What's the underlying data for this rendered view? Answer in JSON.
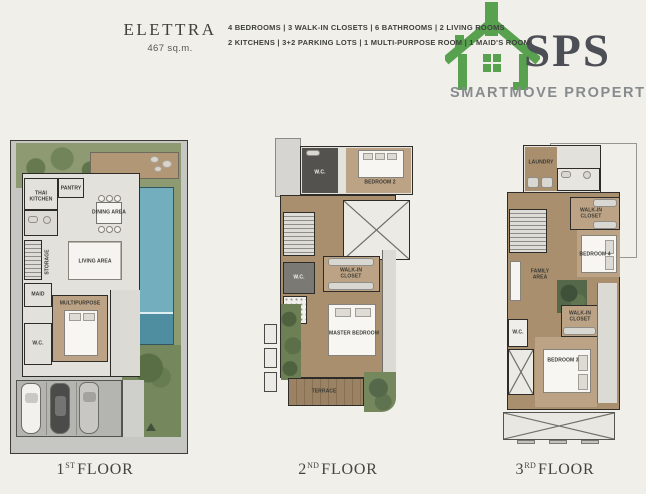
{
  "header": {
    "title": "ELETTRA",
    "area": "467 sq.m.",
    "specs_line1": "4 BEDROOMS   |   3 WALK-IN CLOSETS   |   6 BATHROOMS   |   2 LIVING ROOMS",
    "specs_line2": "2 KITCHENS   |   3+2 PARKING LOTS   |   1 MULTI-PURPOSE ROOM   |   1 MAID'S ROOM"
  },
  "logo": {
    "brand": "SPS",
    "tagline": "SMARTMOVE PROPERTY",
    "house_color": "#57a14f",
    "brand_color": "#4c5056",
    "tagline_color": "#878b8e"
  },
  "colors": {
    "background": "#f1efe9",
    "wall": "#2d2c29",
    "pool_blue": "#73aebe",
    "garden_green": "#8d9a72",
    "wood_floor": "#a98f6e",
    "site_gray": "#c6c6c3"
  },
  "floors": [
    {
      "num": "1",
      "ord": "ST",
      "word": "FLOOR",
      "rooms": {
        "thai_kitchen": "THAI\nKITCHEN",
        "pantry": "PANTRY",
        "dining": "DINING AREA",
        "living": "LIVING AREA",
        "storage": "STORAGE",
        "maid": "MAID",
        "multipurpose": "MULTIPURPOSE",
        "wc": "W.C."
      }
    },
    {
      "num": "2",
      "ord": "ND",
      "word": "FLOOR",
      "rooms": {
        "wc_top": "W.C.",
        "bedroom2": "BEDROOM 2",
        "wc": "W.C.",
        "walkin": "WALK-IN\nCLOSET",
        "master": "MASTER BEDROOM",
        "terrace": "TERRACE"
      }
    },
    {
      "num": "3",
      "ord": "RD",
      "word": "FLOOR",
      "rooms": {
        "laundry": "LAUNDRY",
        "walkin_top": "WALK-IN\nCLOSET",
        "bedroom4": "BEDROOM 4",
        "family": "FAMILY\nAREA",
        "wc": "W.C.",
        "walkin_bottom": "WALK-IN\nCLOSET",
        "bedroom3": "BEDROOM 3"
      }
    }
  ]
}
